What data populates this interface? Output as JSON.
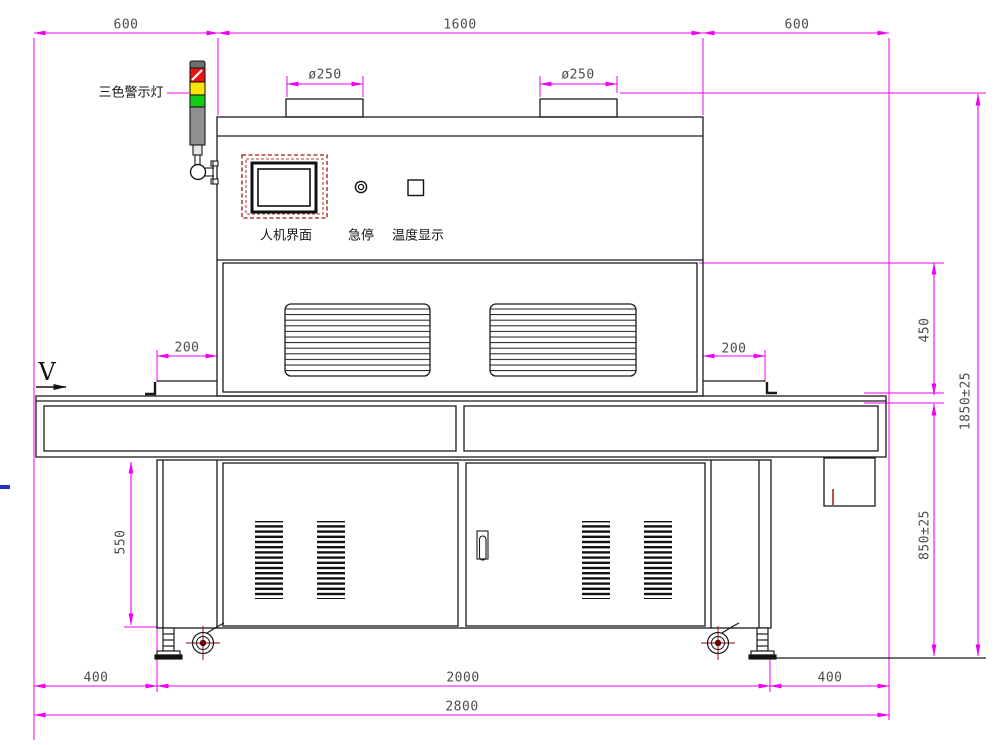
{
  "title": "machine-front-view-drawing",
  "labels": {
    "warning_light": "三色警示灯",
    "hmi": "人机界面",
    "emergency_stop": "急停",
    "temperature_display": "温度显示",
    "direction": "V"
  },
  "dims": {
    "top_left": "600",
    "top_center": "1600",
    "top_right": "600",
    "vent_left": "ø250",
    "vent_right": "ø250",
    "inlet_left": "200",
    "inlet_right": "200",
    "hood_height": "450",
    "total_height": "1850±25",
    "table_height": "850±25",
    "under_table_height": "550",
    "bottom_left": "400",
    "bottom_center": "2000",
    "bottom_right": "400",
    "total_width": "2800"
  },
  "colors": {
    "dimension_line": "#f000f0",
    "outline": "#1a1a1a",
    "dim_text": "#4d4d4d",
    "light_red": "#ee1111",
    "light_yellow": "#ffe400",
    "light_green": "#11cc11",
    "light_gray": "#8f8f8f",
    "hmi_frame_red": "#b04038",
    "caster_mark_red": "#8a0000",
    "blue_mark": "#2233cc"
  }
}
